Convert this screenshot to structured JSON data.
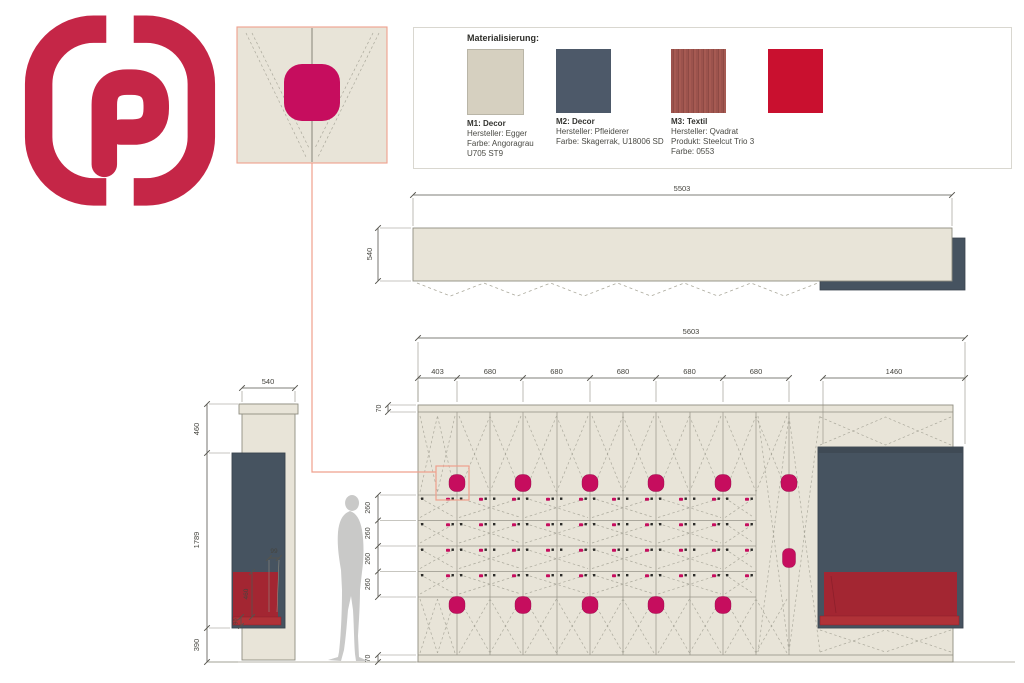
{
  "logo": {
    "letter": "P"
  },
  "materials": {
    "title": "Materialisierung:",
    "items": [
      {
        "name": "M1: Decor",
        "lines": [
          "Hersteller: Egger",
          "Farbe: Angoragrau",
          "U705 ST9"
        ],
        "color": "#d6d0c0",
        "textured": false,
        "bordered": true
      },
      {
        "name": "M2: Decor",
        "lines": [
          "Hersteller: Pfleiderer",
          "Farbe: Skagerrak, U18006 SD"
        ],
        "color": "#4d5969",
        "textured": false,
        "bordered": false
      },
      {
        "name": "M3: Textil",
        "lines": [
          "Hersteller: Qvadrat",
          "Produkt: Steelcut Trio 3",
          "Farbe: 0553"
        ],
        "color": "#9c534d",
        "textured": true,
        "bordered": false
      },
      {
        "name": "",
        "lines": [],
        "color": "#c9102f",
        "textured": false,
        "bordered": false
      }
    ]
  },
  "plan_view": {
    "width": "5503",
    "depth": "540"
  },
  "elevation": {
    "total": "5603",
    "segments": [
      "403",
      "680",
      "680",
      "680",
      "680",
      "680"
    ],
    "wide_segment": "1460",
    "cap": "70",
    "rows": [
      "260",
      "260",
      "260",
      "260"
    ],
    "plinth": "70"
  },
  "side_view": {
    "width": "540",
    "top": "460",
    "middle": "1789",
    "bottom": "390",
    "cushion": "460",
    "edge": "99",
    "strip": "90"
  },
  "colors": {
    "logo": "#c52647",
    "beige": "#e8e4d8",
    "slate": "#465360",
    "slate_dark": "#3a444e",
    "magenta": "#c60d5e",
    "cushion": "#a32632",
    "cushion_strip": "#b03238",
    "salmon": "#efa08d",
    "outline": "#8f8d81",
    "dim": "#55544e",
    "ext": "#908e82",
    "dash": "#aba99c",
    "silhouette": "#c9c9c8"
  }
}
